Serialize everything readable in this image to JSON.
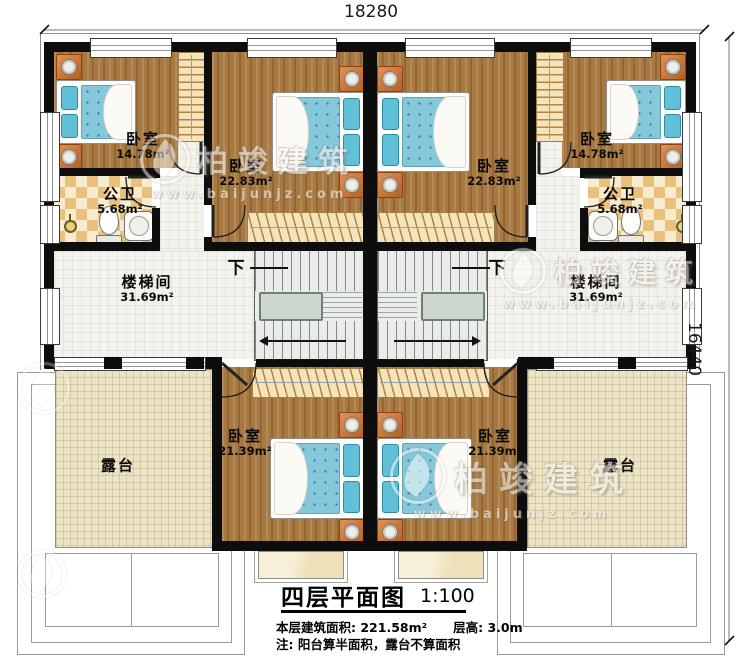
{
  "dimensions": {
    "top": "18280",
    "right": "16440"
  },
  "rooms": {
    "bedroom_top_left": {
      "name": "卧室",
      "area": "14.78m²"
    },
    "bedroom_mid_left": {
      "name": "卧室",
      "area": "22.83m²"
    },
    "bedroom_mid_right": {
      "name": "卧室",
      "area": "22.83m²"
    },
    "bedroom_top_right": {
      "name": "卧室",
      "area": "14.78m²"
    },
    "bath_left": {
      "name": "公卫",
      "area": "5.68m²"
    },
    "bath_right": {
      "name": "公卫",
      "area": "5.68m²"
    },
    "stair_left": {
      "name": "楼梯间",
      "area": "31.69m²"
    },
    "stair_right": {
      "name": "楼梯间",
      "area": "31.69m²"
    },
    "bedroom_bottom_left": {
      "name": "卧室",
      "area": "21.39m²"
    },
    "bedroom_bottom_right": {
      "name": "卧室",
      "area": "21.39m²"
    },
    "terrace_left": {
      "name": "露台"
    },
    "terrace_right": {
      "name": "露台"
    }
  },
  "stairs": {
    "down_label": "下"
  },
  "title_block": {
    "title": "四层平面图",
    "scale": "1:100",
    "area_line": "本层建筑面积: 221.58m²",
    "height_line": "层高: 3.0m",
    "note": "注: 阳台算半面积，露台不算面积"
  },
  "watermark": {
    "brand": "柏竣建筑",
    "url": "www.baijunjz.com"
  },
  "colors": {
    "wall": "#0d0d0d",
    "wood": "#a87a42",
    "bed_blue": "#85c7db",
    "pillow": "#5fc0d8",
    "nightstand": "#cf7a3d",
    "checker": "#e9c17d",
    "checker_light": "#f8ecd0",
    "tile": "#f3f2ec",
    "terrace": "#ece4c5",
    "landing": "#ccd7cf"
  }
}
